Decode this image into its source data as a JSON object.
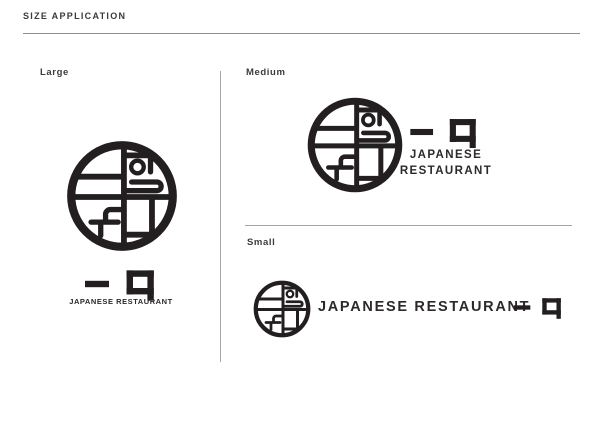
{
  "header": {
    "title": "SIZE APPLICATION"
  },
  "brand": {
    "kanji": "一口",
    "name": "JAPANESE RESTAURANT",
    "ink_color": "#231f20",
    "divider_color": "#a5a5a5",
    "label_color": "#3c3c3c"
  },
  "sections": [
    {
      "id": "large",
      "label": "Large",
      "tagline": "JAPANESE RESTAURANT"
    },
    {
      "id": "medium",
      "label": "Medium",
      "tagline_lines": [
        "JAPANESE",
        "RESTAURANT"
      ]
    },
    {
      "id": "small",
      "label": "Small",
      "tagline": "JAPANESE RESTAURANT"
    }
  ],
  "icons": {
    "logo_mark": "circular-bento-bowl-logo",
    "kanji_mark": "hitokuchi-kanji-logotype"
  }
}
